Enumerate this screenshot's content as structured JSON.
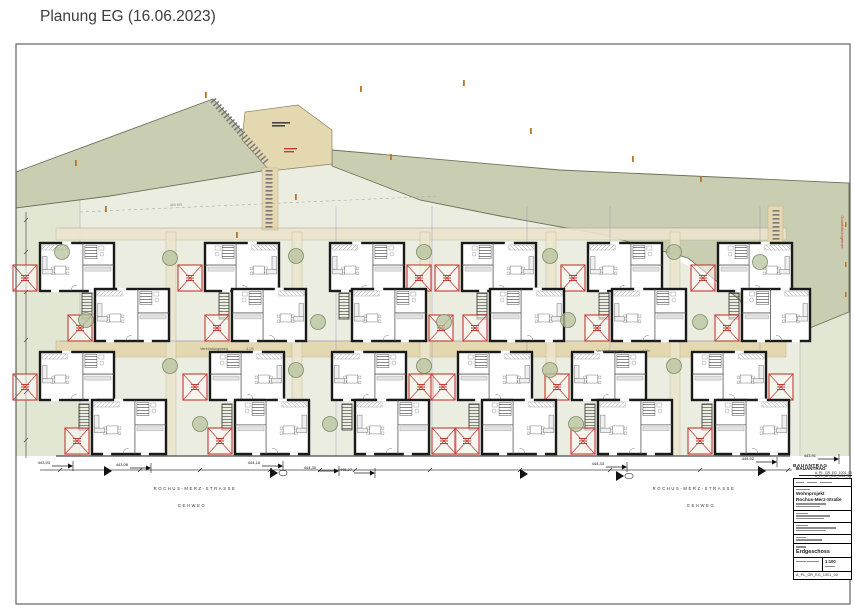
{
  "page": {
    "title": "Planung EG (16.06.2023)"
  },
  "title_block": {
    "header": "BAUANTRAG",
    "doc_no_top": "A_PL_GR_EG_1001_00",
    "project_line1": "Wohnprojekt",
    "project_line2": "Rochus-Merz-Straße",
    "plan_title": "Erdgeschoss",
    "scale": "1:100",
    "doc_no_bottom": "A_PL_GR_EG_1001_00"
  },
  "drawing": {
    "frame": {
      "x": 16,
      "y": 44,
      "w": 834,
      "h": 560
    },
    "colors": {
      "sage": "#c9ceb2",
      "pale": "#e2e7d4",
      "ground": "#ebede0",
      "tan": "#e3d8b0",
      "tanLight": "#ece5cd",
      "wall": "#1a1a1a",
      "red": "#c53b33",
      "treeFill": "#b7c29e",
      "treeStroke": "#7d8c66",
      "purple": "#8d7fc7",
      "orange": "#b5762f",
      "dim": "#333333",
      "frame": "#555555"
    },
    "polygons": [
      {
        "n": "plot-ground",
        "pts": "16,206 110,194 268,168 332,163 420,198 520,220 640,236 742,300 764,352 800,332 849,312 849,460 16,460",
        "f": "ground"
      },
      {
        "n": "garden-strip-left",
        "pts": "16,206 80,197 80,460 16,460",
        "f": "pale",
        "st": "#a9ae93",
        "sw": 0.5
      },
      {
        "n": "garden-strip-right",
        "pts": "800,332 849,312 849,460 800,460",
        "f": "pale",
        "st": "#a9ae93",
        "sw": 0.5
      },
      {
        "n": "green-area-left",
        "pts": "16,172 213,99 268,160 268,170 110,196 16,208",
        "f": "sage",
        "st": "#6d725a",
        "sw": 0.9
      },
      {
        "n": "green-area-right",
        "pts": "332,150 560,170 849,183 849,312 800,332 762,352 740,300 688,258 600,234 500,216 420,200 332,166",
        "f": "sage",
        "st": "#6d725a",
        "sw": 0.9
      },
      {
        "n": "entry-court",
        "pts": "245,112 298,105 332,130 332,164 270,171 242,140",
        "f": "tan",
        "st": "#8a8060",
        "sw": 0.7
      },
      {
        "n": "street-zone",
        "pts": "16,456 850,456 850,604 16,604",
        "f": "#ffffff"
      }
    ],
    "rects": [
      {
        "n": "connecting-path",
        "x": 56,
        "y": 341,
        "w": 730,
        "h": 16,
        "f": "tan",
        "o": 1
      },
      {
        "n": "north-path",
        "x": 56,
        "y": 228,
        "w": 730,
        "h": 12,
        "f": "tanLight",
        "o": 0.9
      },
      {
        "n": "side-path",
        "x": 166,
        "y": 232,
        "w": 10,
        "h": 224,
        "f": "tanLight",
        "o": 0.85
      },
      {
        "n": "side-path",
        "x": 292,
        "y": 232,
        "w": 10,
        "h": 224,
        "f": "tanLight",
        "o": 0.85
      },
      {
        "n": "side-path",
        "x": 420,
        "y": 232,
        "w": 10,
        "h": 224,
        "f": "tanLight",
        "o": 0.85
      },
      {
        "n": "side-path",
        "x": 546,
        "y": 232,
        "w": 10,
        "h": 224,
        "f": "tanLight",
        "o": 0.85
      },
      {
        "n": "side-path",
        "x": 670,
        "y": 232,
        "w": 10,
        "h": 224,
        "f": "tanLight",
        "o": 0.85
      },
      {
        "n": "entry-ramp",
        "x": 262,
        "y": 168,
        "w": 16,
        "h": 62,
        "f": "tan",
        "o": 1
      },
      {
        "n": "east-ramp",
        "x": 768,
        "y": 206,
        "w": 15,
        "h": 98,
        "f": "tan",
        "o": 1
      }
    ],
    "ladders": [
      {
        "x1": 213,
        "y1": 100,
        "x2": 266,
        "y2": 162
      },
      {
        "x1": 269,
        "y1": 170,
        "x2": 269,
        "y2": 228
      },
      {
        "x1": 776,
        "y1": 210,
        "x2": 776,
        "y2": 300
      }
    ],
    "lines": [
      {
        "x1": 80,
        "y1": 212,
        "x2": 440,
        "y2": 196,
        "c": "#aaaaaa",
        "w": 0.6,
        "d": "3 3"
      },
      {
        "x1": 336,
        "y1": 206,
        "x2": 336,
        "y2": 456,
        "c": "purple",
        "w": 0.7,
        "o": 0.5
      },
      {
        "x1": 432,
        "y1": 206,
        "x2": 432,
        "y2": 456,
        "c": "purple",
        "w": 0.7,
        "o": 0.5
      },
      {
        "x1": 527,
        "y1": 206,
        "x2": 527,
        "y2": 456,
        "c": "purple",
        "w": 0.7,
        "o": 0.5
      },
      {
        "x1": 610,
        "y1": 206,
        "x2": 610,
        "y2": 456,
        "c": "purple",
        "w": 0.7,
        "o": 0.5
      },
      {
        "x1": 760,
        "y1": 206,
        "x2": 760,
        "y2": 456,
        "c": "purple",
        "w": 0.7,
        "o": 0.5
      },
      {
        "x1": 60,
        "y1": 341,
        "x2": 780,
        "y2": 341,
        "c": "purple",
        "w": 0.8,
        "o": 0.6
      },
      {
        "x1": 60,
        "y1": 228,
        "x2": 780,
        "y2": 228,
        "c": "purple",
        "w": 0.5,
        "o": 0.4
      },
      {
        "x1": 56,
        "y1": 456,
        "x2": 790,
        "y2": 456,
        "c": "#222222",
        "w": 1
      },
      {
        "x1": 40,
        "y1": 470,
        "x2": 792,
        "y2": 470,
        "c": "#444444",
        "w": 0.7
      },
      {
        "x1": 26,
        "y1": 212,
        "x2": 26,
        "y2": 458,
        "c": "#555555",
        "w": 0.7
      },
      {
        "x1": 806,
        "y1": 478.5,
        "x2": 851,
        "y2": 478.5,
        "c": "#222222",
        "w": 0.5
      }
    ],
    "dim_ticks": [
      60,
      140,
      200,
      270,
      320,
      355,
      430,
      520,
      610,
      700,
      760,
      788
    ],
    "left_dim_ticks": [
      220,
      252,
      292,
      340,
      392,
      440
    ],
    "units": [
      {
        "x": 40,
        "y": 243,
        "w": 74,
        "h": 48,
        "t": "l",
        "s": 0
      },
      {
        "x": 205,
        "y": 243,
        "w": 74,
        "h": 48,
        "t": "l",
        "s": 0
      },
      {
        "x": 330,
        "y": 243,
        "w": 74,
        "h": 48,
        "t": "r",
        "s": 0
      },
      {
        "x": 462,
        "y": 243,
        "w": 74,
        "h": 48,
        "t": "l",
        "s": 0
      },
      {
        "x": 588,
        "y": 243,
        "w": 74,
        "h": 48,
        "t": "l",
        "s": 0
      },
      {
        "x": 718,
        "y": 243,
        "w": 74,
        "h": 48,
        "t": "l",
        "s": 0
      },
      {
        "x": 95,
        "y": 289,
        "w": 74,
        "h": 52,
        "t": "l",
        "s": 1
      },
      {
        "x": 232,
        "y": 289,
        "w": 74,
        "h": 52,
        "t": "l",
        "s": 1
      },
      {
        "x": 352,
        "y": 289,
        "w": 74,
        "h": 52,
        "t": "r",
        "s": 1
      },
      {
        "x": 490,
        "y": 289,
        "w": 74,
        "h": 52,
        "t": "l",
        "s": 1
      },
      {
        "x": 612,
        "y": 289,
        "w": 74,
        "h": 52,
        "t": "l",
        "s": 1
      },
      {
        "x": 742,
        "y": 289,
        "w": 68,
        "h": 52,
        "t": "l",
        "s": 1
      },
      {
        "x": 40,
        "y": 352,
        "w": 74,
        "h": 48,
        "t": "l",
        "s": 0
      },
      {
        "x": 210,
        "y": 352,
        "w": 74,
        "h": 48,
        "t": "l",
        "s": 0
      },
      {
        "x": 332,
        "y": 352,
        "w": 74,
        "h": 48,
        "t": "r",
        "s": 0
      },
      {
        "x": 458,
        "y": 352,
        "w": 74,
        "h": 48,
        "t": "l",
        "s": 0
      },
      {
        "x": 572,
        "y": 352,
        "w": 74,
        "h": 48,
        "t": "l",
        "s": 0
      },
      {
        "x": 692,
        "y": 352,
        "w": 74,
        "h": 48,
        "t": "r",
        "s": 0
      },
      {
        "x": 92,
        "y": 400,
        "w": 74,
        "h": 54,
        "t": "l",
        "s": 1
      },
      {
        "x": 235,
        "y": 400,
        "w": 74,
        "h": 54,
        "t": "l",
        "s": 1
      },
      {
        "x": 355,
        "y": 400,
        "w": 74,
        "h": 54,
        "t": "r",
        "s": 1
      },
      {
        "x": 482,
        "y": 400,
        "w": 74,
        "h": 54,
        "t": "l",
        "s": 1
      },
      {
        "x": 598,
        "y": 400,
        "w": 74,
        "h": 54,
        "t": "l",
        "s": 1
      },
      {
        "x": 715,
        "y": 400,
        "w": 74,
        "h": 54,
        "t": "l",
        "s": 1
      }
    ],
    "trees": [
      [
        62,
        252
      ],
      [
        170,
        258
      ],
      [
        296,
        256
      ],
      [
        424,
        252
      ],
      [
        550,
        256
      ],
      [
        674,
        252
      ],
      [
        86,
        320
      ],
      [
        318,
        322
      ],
      [
        444,
        322
      ],
      [
        568,
        320
      ],
      [
        700,
        322
      ],
      [
        760,
        262
      ],
      [
        170,
        366
      ],
      [
        296,
        370
      ],
      [
        424,
        366
      ],
      [
        550,
        370
      ],
      [
        674,
        366
      ],
      [
        200,
        424
      ],
      [
        330,
        424
      ],
      [
        576,
        424
      ]
    ],
    "bars": [
      {
        "x": 272,
        "y": 122,
        "w": 18,
        "h": 1.6,
        "c": "#444444"
      },
      {
        "x": 272,
        "y": 125,
        "w": 13,
        "h": 1.6,
        "c": "#444444"
      },
      {
        "x": 284,
        "y": 148,
        "w": 13,
        "h": 1.4,
        "c": "red"
      },
      {
        "x": 284,
        "y": 151,
        "w": 10,
        "h": 1.4,
        "c": "red"
      },
      {
        "x": 75,
        "y": 160,
        "w": 1.8,
        "h": 6,
        "c": "orange"
      },
      {
        "x": 105,
        "y": 206,
        "w": 1.8,
        "h": 6,
        "c": "orange"
      },
      {
        "x": 205,
        "y": 92,
        "w": 1.8,
        "h": 6,
        "c": "orange"
      },
      {
        "x": 236,
        "y": 232,
        "w": 1.8,
        "h": 6,
        "c": "orange"
      },
      {
        "x": 295,
        "y": 194,
        "w": 1.8,
        "h": 6,
        "c": "orange"
      },
      {
        "x": 360,
        "y": 86,
        "w": 1.8,
        "h": 6,
        "c": "orange"
      },
      {
        "x": 390,
        "y": 154,
        "w": 1.8,
        "h": 6,
        "c": "orange"
      },
      {
        "x": 463,
        "y": 80,
        "w": 1.8,
        "h": 6,
        "c": "orange"
      },
      {
        "x": 530,
        "y": 128,
        "w": 1.8,
        "h": 6,
        "c": "orange"
      },
      {
        "x": 632,
        "y": 156,
        "w": 1.8,
        "h": 6,
        "c": "orange"
      },
      {
        "x": 700,
        "y": 176,
        "w": 1.8,
        "h": 6,
        "c": "orange"
      },
      {
        "x": 845,
        "y": 222,
        "w": 1.5,
        "h": 5,
        "c": "orange"
      },
      {
        "x": 845,
        "y": 262,
        "w": 1.5,
        "h": 5,
        "c": "orange"
      },
      {
        "x": 845,
        "y": 292,
        "w": 1.5,
        "h": 5,
        "c": "orange"
      }
    ],
    "labels": [
      {
        "n": "street-label",
        "t": "ROCHUS-MERZ-STRASSE",
        "x": 195,
        "y": 490,
        "s": 4.2,
        "c": "#333333",
        "ls": 1.6
      },
      {
        "n": "sidewalk-label",
        "t": "GEHWEG",
        "x": 192,
        "y": 507,
        "s": 4.2,
        "c": "#333333",
        "ls": 1.6
      },
      {
        "n": "street-label",
        "t": "ROCHUS-MERZ-STRASSE",
        "x": 694,
        "y": 490,
        "s": 4.2,
        "c": "#333333",
        "ls": 1.6
      },
      {
        "n": "sidewalk-label",
        "t": "GEHWEG",
        "x": 701,
        "y": 507,
        "s": 4.2,
        "c": "#333333",
        "ls": 1.6
      },
      {
        "n": "path-label",
        "t": "Verbindungsweg",
        "x": 214,
        "y": 350,
        "s": 3.8,
        "c": "#555555"
      },
      {
        "n": "path-slope-label",
        "t": "4,1%",
        "x": 250,
        "y": 350,
        "s": 3.4,
        "c": "#555555"
      },
      {
        "n": "path-label",
        "t": "Verbindungsweg",
        "x": 610,
        "y": 352,
        "s": 3.8,
        "c": "#555555"
      },
      {
        "n": "path-slope-label",
        "t": "4,1%",
        "x": 646,
        "y": 352,
        "s": 3.4,
        "c": "#555555"
      },
      {
        "n": "contour-label",
        "t": "400 NN",
        "x": 176,
        "y": 206,
        "s": 3.6,
        "c": "#888888",
        "r": -2
      },
      {
        "n": "boundary-label",
        "t": "Grundstücksgrenze",
        "x": 841,
        "y": 232,
        "s": 3.8,
        "c": "red",
        "r": 90
      },
      {
        "n": "doc-type-note",
        "t": "BAUANTRAG",
        "x": 796,
        "y": 470,
        "s": 4.6,
        "c": "#111111",
        "b": 1,
        "a": "start"
      },
      {
        "n": "doc-number-note",
        "t": "A_PL_GR_EG_1001_00",
        "x": 851,
        "y": 477,
        "s": 3.3,
        "c": "#111111",
        "a": "end"
      }
    ],
    "elevation_markers": [
      {
        "t": "443,93",
        "x": 52,
        "y": 464
      },
      {
        "t": "443,08",
        "x": 130,
        "y": 466
      },
      {
        "t": "444,18",
        "x": 262,
        "y": 464
      },
      {
        "t": "444,30",
        "x": 318,
        "y": 469
      },
      {
        "t": "445,27",
        "x": 354,
        "y": 471
      },
      {
        "t": "444,33",
        "x": 606,
        "y": 465
      },
      {
        "t": "444,92",
        "x": 756,
        "y": 460
      },
      {
        "t": "443,91",
        "x": 818,
        "y": 457
      }
    ],
    "street_markers": [
      {
        "x": 104,
        "y": 471,
        "e": 0
      },
      {
        "x": 270,
        "y": 473,
        "e": 1
      },
      {
        "x": 520,
        "y": 474,
        "e": 0
      },
      {
        "x": 616,
        "y": 476,
        "e": 1
      },
      {
        "x": 758,
        "y": 471,
        "e": 0
      }
    ]
  }
}
